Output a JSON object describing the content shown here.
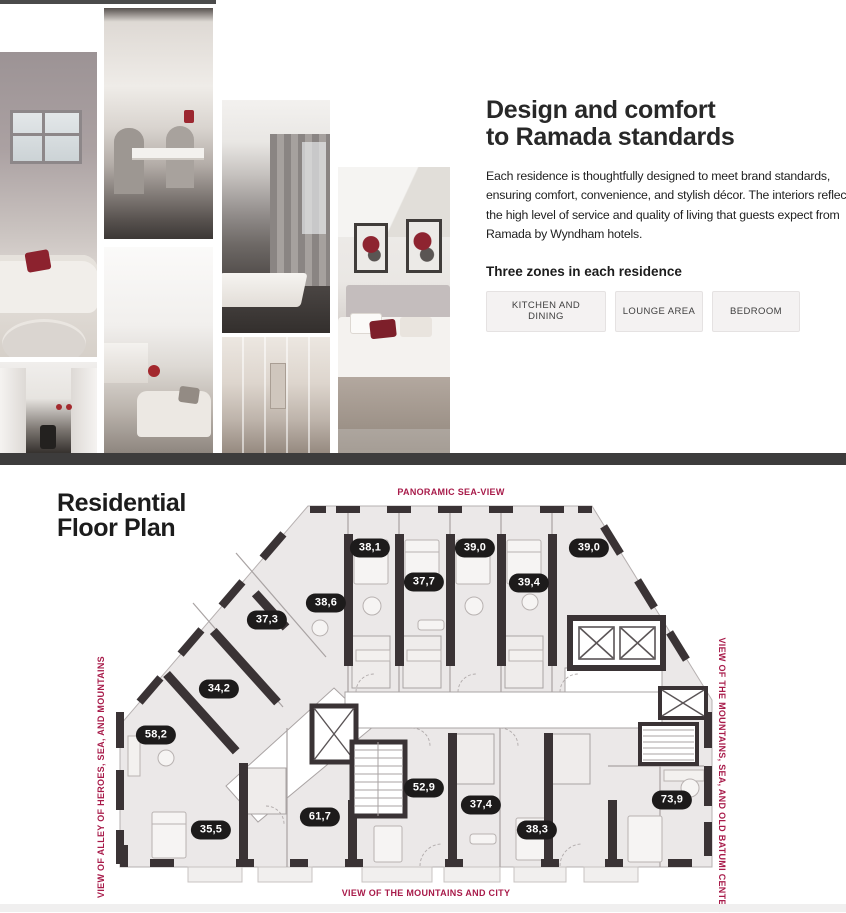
{
  "hero": {
    "title_line1": "Design and comfort",
    "title_line2": "to Ramada standards",
    "description_lines": [
      "Each residence is thoughtfully designed to meet brand standards,",
      "ensuring comfort, convenience, and stylish décor. The interiors reflect",
      "the high level of service and quality of living that guests expect from",
      "Ramada by Wyndham hotels."
    ],
    "zones_heading": "Three zones in each residence",
    "zone_buttons": [
      {
        "label": "KITCHEN AND DINING"
      },
      {
        "label": "LOUNGE AREA"
      },
      {
        "label": "BEDROOM"
      }
    ],
    "photos": [
      {
        "name": "living-room-sofa"
      },
      {
        "name": "kitchen-dining-table"
      },
      {
        "name": "dining-table-curtains"
      },
      {
        "name": "bedroom-red-pillows"
      },
      {
        "name": "lounge-area"
      },
      {
        "name": "bathroom-shower"
      },
      {
        "name": "galley-kitchen"
      }
    ]
  },
  "floor_plan": {
    "title_line1": "Residential",
    "title_line2": "Floor Plan",
    "labels": {
      "top": "PANORAMIC SEA-VIEW",
      "bottom": "VIEW OF THE MOUNTAINS AND CITY",
      "left": "VIEW OF ALLEY OF HEROES, SEA, AND MOUNTAINS",
      "right": "VIEW OF THE MOUNTAINS, SEA, AND OLD BATUMI CENTER"
    },
    "accent_color": "#a81b4a",
    "badge_color": "#1d1b1b",
    "units": [
      {
        "area": "38,1",
        "x": 370,
        "y": 548
      },
      {
        "area": "39,0",
        "x": 475,
        "y": 548
      },
      {
        "area": "39,0",
        "x": 589,
        "y": 548
      },
      {
        "area": "37,7",
        "x": 424,
        "y": 582
      },
      {
        "area": "39,4",
        "x": 529,
        "y": 583
      },
      {
        "area": "38,6",
        "x": 326,
        "y": 603
      },
      {
        "area": "37,3",
        "x": 267,
        "y": 620
      },
      {
        "area": "34,2",
        "x": 219,
        "y": 689
      },
      {
        "area": "58,2",
        "x": 156,
        "y": 735
      },
      {
        "area": "35,5",
        "x": 211,
        "y": 830
      },
      {
        "area": "61,7",
        "x": 320,
        "y": 817
      },
      {
        "area": "52,9",
        "x": 424,
        "y": 788
      },
      {
        "area": "37,4",
        "x": 481,
        "y": 805
      },
      {
        "area": "38,3",
        "x": 537,
        "y": 830
      },
      {
        "area": "73,9",
        "x": 672,
        "y": 800
      }
    ]
  }
}
